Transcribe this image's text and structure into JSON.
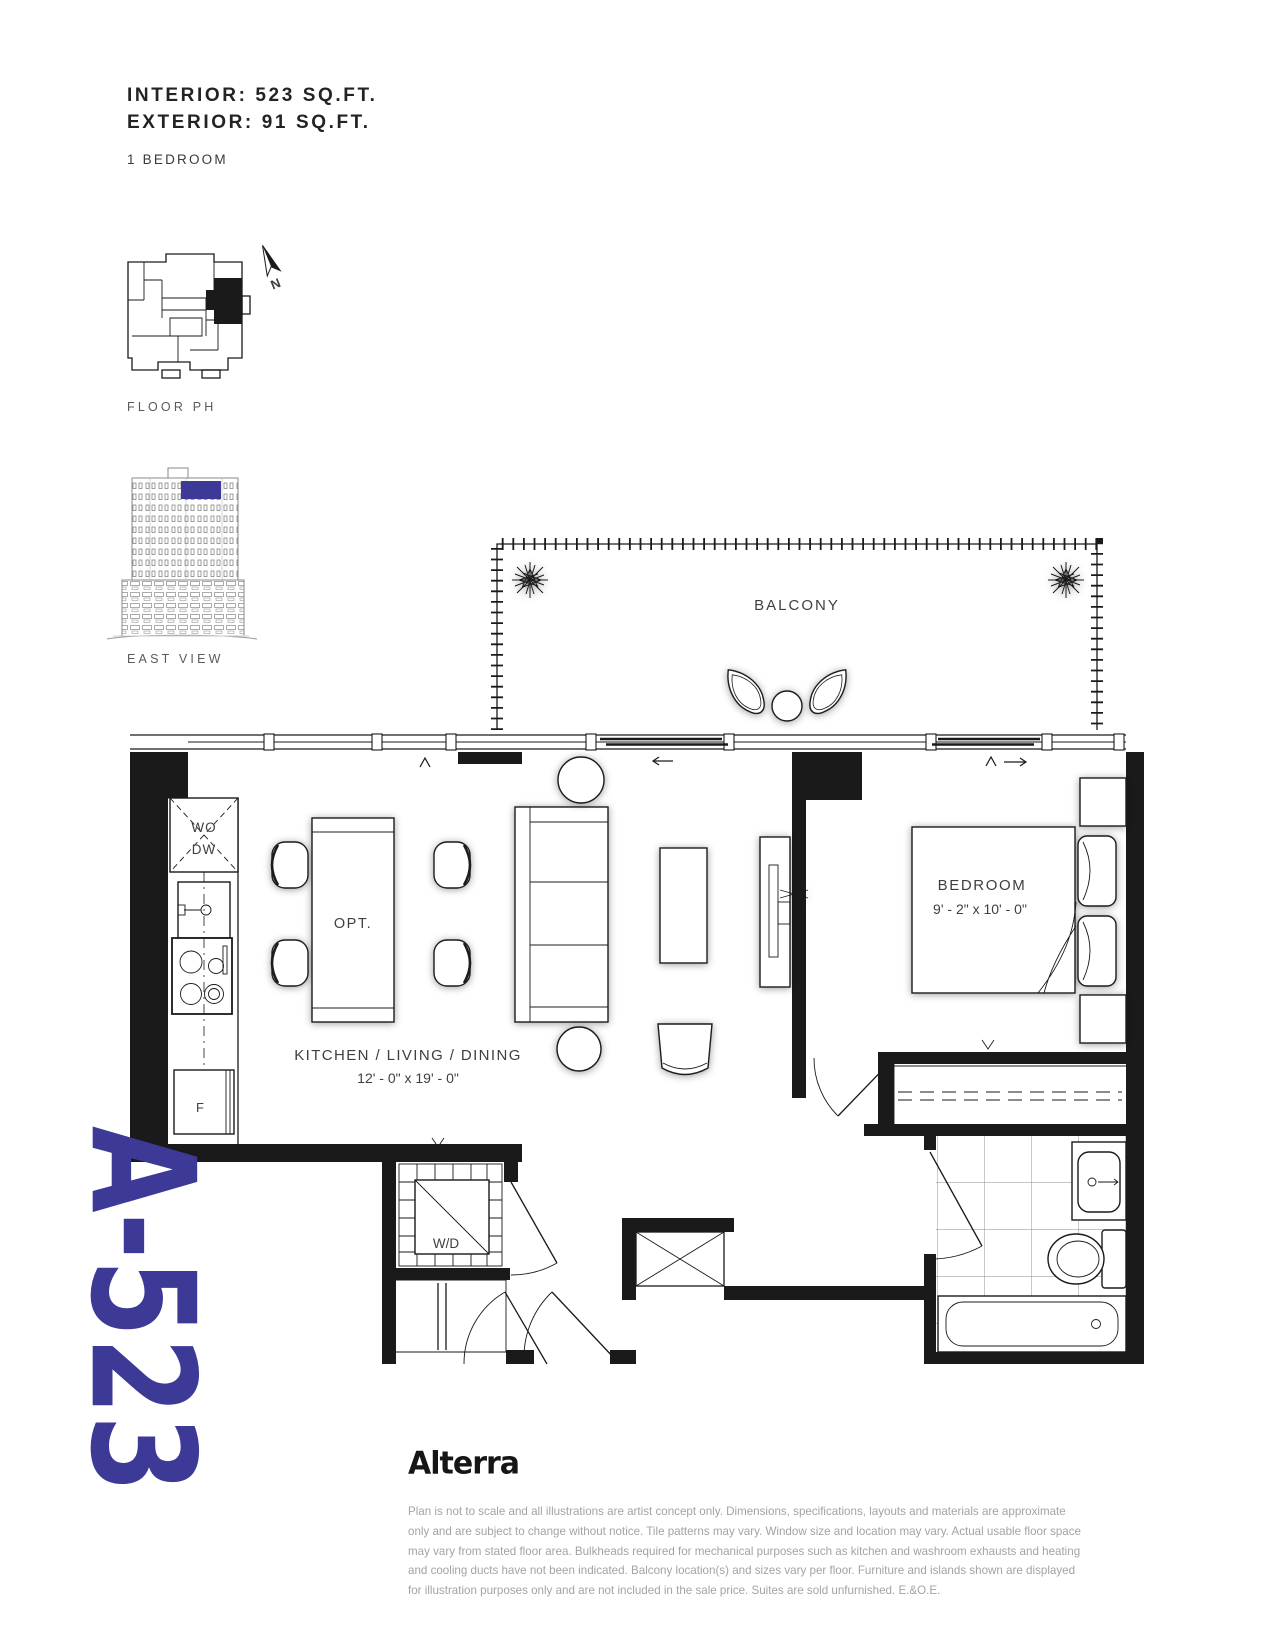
{
  "header": {
    "interior_area": "INTERIOR: 523 SQ.FT.",
    "exterior_area": "EXTERIOR: 91 SQ.FT.",
    "bedroom_type": "1 BEDROOM"
  },
  "key_plan": {
    "floor_label": "FLOOR PH",
    "north_label": "N"
  },
  "elevation": {
    "view_label": "EAST VIEW"
  },
  "plan": {
    "balcony_label": "BALCONY",
    "kitchen_living_label": "KITCHEN / LIVING / DINING",
    "kitchen_living_dims": "12' - 0\"  x 19' - 0\"",
    "bedroom_label": "BEDROOM",
    "bedroom_dims": "9' - 2\" x  10' - 0\"",
    "dining_opt_label": "OPT.",
    "washer_dryer_label": "W/D",
    "wall_oven_label": "WO",
    "dishwasher_label": "DW",
    "fridge_label": "F"
  },
  "unit": {
    "number": "A-523",
    "accent_color": "#3d3a97"
  },
  "brand": {
    "logo_text": "Alterra"
  },
  "disclaimer": {
    "lines": [
      "Plan is not to scale and all illustrations are artist concept only. Dimensions, specifications, layouts and materials are approximate",
      "only and are subject to change without notice. Tile patterns may vary. Window size and location may vary. Actual usable floor space",
      "may vary from stated floor area. Bulkheads required for mechanical purposes such as kitchen and washroom exhausts and heating",
      "and cooling ducts have not been indicated. Balcony location(s) and sizes vary per floor. Furniture and islands shown are displayed",
      "for illustration purposes only and are not included in the sale price. Suites are sold unfurnished. E.&O.E."
    ]
  }
}
